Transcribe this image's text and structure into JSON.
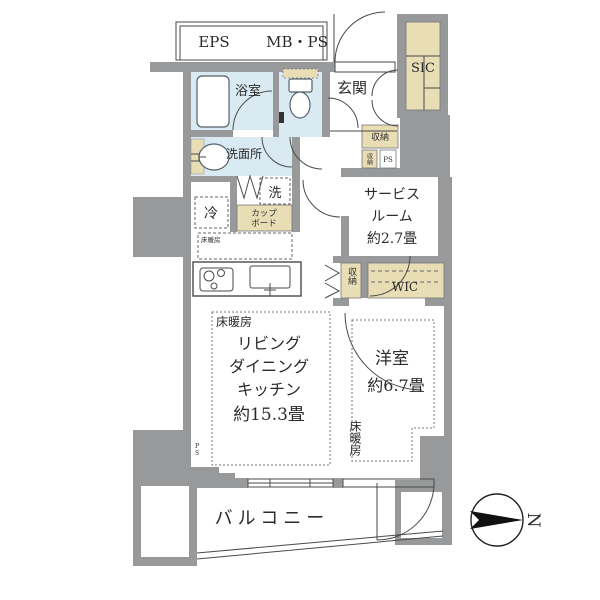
{
  "colors": {
    "wall": "#98999b",
    "wet_room": "#d9eaf3",
    "storage": "#e8ddb5",
    "line": "#4a4a4a",
    "text": "#2b2b2b"
  },
  "corridor": {
    "eps": "EPS",
    "mb_ps": "MB・PS"
  },
  "rooms": {
    "entrance": {
      "label": "玄関"
    },
    "shoe_closet": {
      "label": "SIC"
    },
    "bathroom": {
      "label": "浴室"
    },
    "washroom": {
      "label": "洗面所"
    },
    "washer": {
      "label": "洗"
    },
    "refrigerator": {
      "label": "冷"
    },
    "cupboard": {
      "line1": "カップ",
      "line2": "ボード"
    },
    "kitchen_floor_heating": {
      "label": "床暖房"
    },
    "hall_storage": {
      "label": "収納"
    },
    "hall_storage_small": {
      "label": "収納"
    },
    "pipe_space": {
      "label": "PS"
    },
    "pipe_space_left": {
      "label": "PS"
    },
    "service_room": {
      "line1": "サービス",
      "line2": "ルーム",
      "line3": "約2.7畳"
    },
    "wic": {
      "label": "WIC"
    },
    "ldk_closet": {
      "label": "収納"
    },
    "ldk": {
      "floor_heating": "床暖房",
      "line1": "リビング",
      "line2": "ダイニング",
      "line3": "キッチン",
      "line4": "約15.3畳"
    },
    "western_room": {
      "label": "洋室",
      "size": "約6.7畳",
      "floor_heating": "床暖房"
    },
    "balcony": {
      "label": "バルコニー"
    }
  },
  "compass": {
    "north": "N"
  }
}
